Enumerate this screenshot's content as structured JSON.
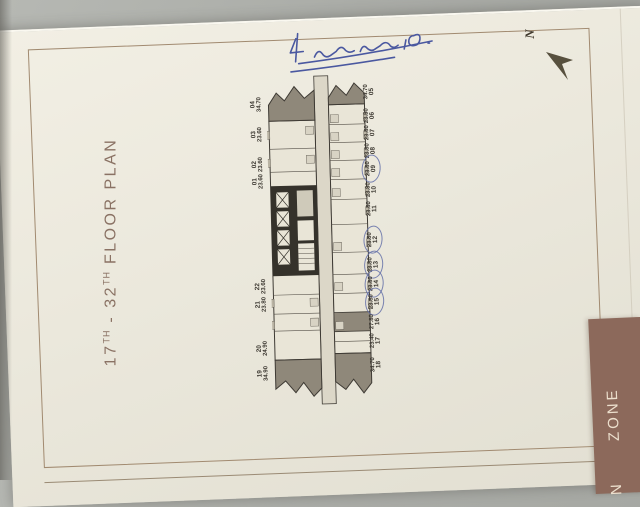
{
  "page": {
    "title": {
      "part1": "17",
      "sup1": "TH",
      "part2": " - 32",
      "sup2": "TH",
      "part3": " FLOOR PLAN"
    },
    "north_label": "N",
    "zone_tab": {
      "visible_text": "ZONE",
      "partial_letter": "N"
    }
  },
  "handwritten_note": {
    "visible_figure": "19",
    "description": "illegible blue-ink handwritten note with two underlines"
  },
  "floor_plan": {
    "units_left": [
      {
        "number": "04",
        "area": "34.70",
        "y": 33
      },
      {
        "number": "03",
        "area": "23.60",
        "y": 63
      },
      {
        "number": "02",
        "area": "23.60",
        "y": 93
      },
      {
        "number": "01",
        "area": "23.60",
        "y": 110
      },
      {
        "number": "22",
        "area": "23.60",
        "y": 215
      },
      {
        "number": "21",
        "area": "23.80",
        "y": 233
      },
      {
        "number": "20",
        "area": "24.90",
        "y": 277
      },
      {
        "number": "19",
        "area": "34.90",
        "y": 302
      }
    ],
    "units_right": [
      {
        "number": "05",
        "area": "34.70",
        "y": 23
      },
      {
        "number": "06",
        "area": "23.50",
        "y": 47
      },
      {
        "number": "07",
        "area": "23.80",
        "y": 64
      },
      {
        "number": "08",
        "area": "23.80",
        "y": 82
      },
      {
        "number": "09",
        "area": "23.80",
        "y": 100,
        "circled": true
      },
      {
        "number": "10",
        "area": "23.80",
        "y": 121
      },
      {
        "number": "11",
        "area": "23.80",
        "y": 140
      },
      {
        "number": "12",
        "area": "23.80",
        "y": 171,
        "circled": true
      },
      {
        "number": "13",
        "area": "23.80",
        "y": 196,
        "circled": true
      },
      {
        "number": "14",
        "area": "23.80",
        "y": 215,
        "circled": true
      },
      {
        "number": "15",
        "area": "23.80",
        "y": 233,
        "circled": true
      },
      {
        "number": "16",
        "area": "27.80",
        "y": 253
      },
      {
        "number": "17",
        "area": "23.40",
        "y": 272
      },
      {
        "number": "18",
        "area": "34.70",
        "y": 296
      }
    ],
    "circled_unit_numbers": [
      "09",
      "12",
      "13",
      "14",
      "15"
    ]
  },
  "colors": {
    "title_brown": "#8a7264",
    "ink_blue": "#4a58a0",
    "circle_blue": "#6470a8",
    "zone_band_brown": "#8c695b",
    "dark_unit_gray": "#8f887a",
    "core_black": "#35322b",
    "page_cream": "#ebe8dc"
  }
}
